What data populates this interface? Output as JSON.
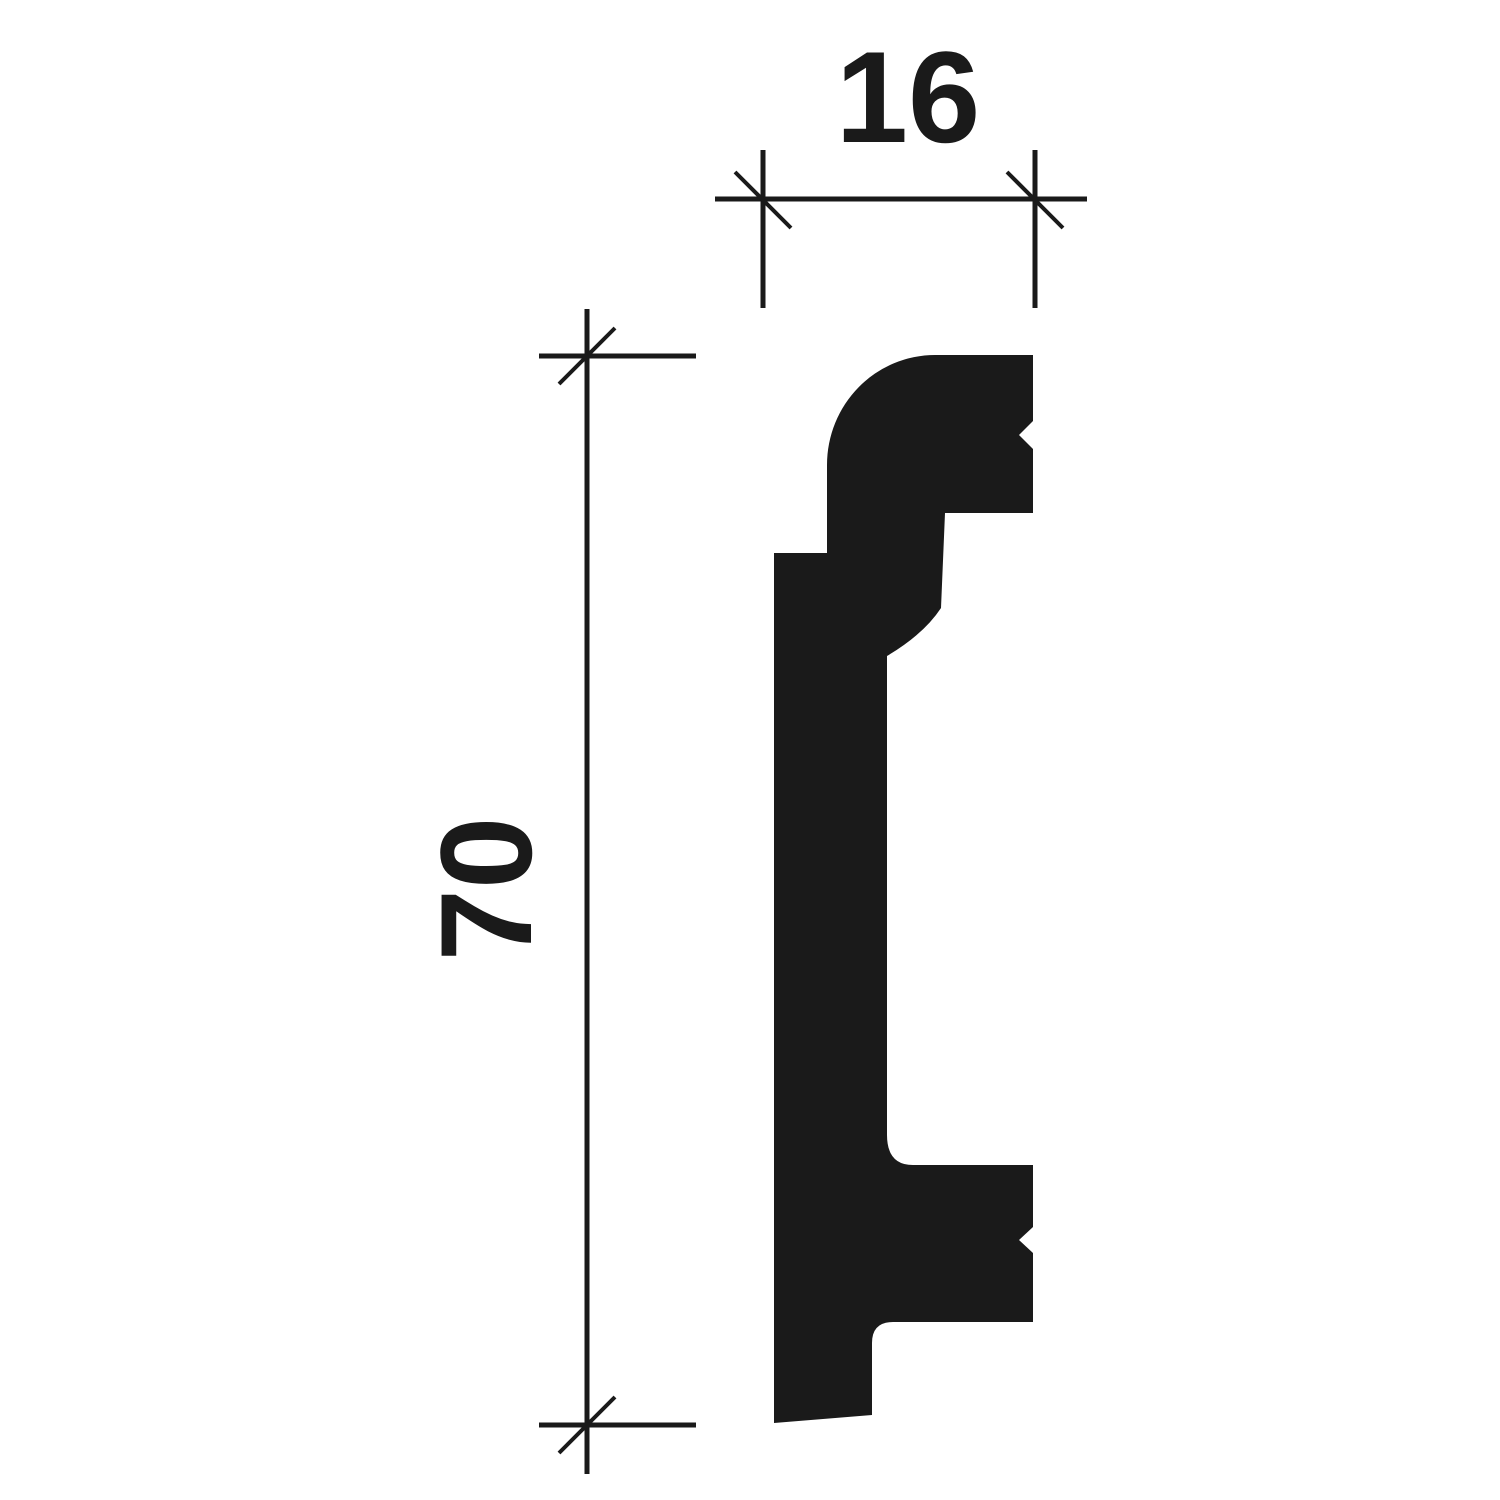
{
  "drawing": {
    "ink_color": "#1a1a1a",
    "background_color": "#ffffff",
    "subject": "molding-profile-cross-section",
    "width_dimension": {
      "label": "16",
      "value": 16
    },
    "height_dimension": {
      "label": "70",
      "value": 70
    }
  }
}
